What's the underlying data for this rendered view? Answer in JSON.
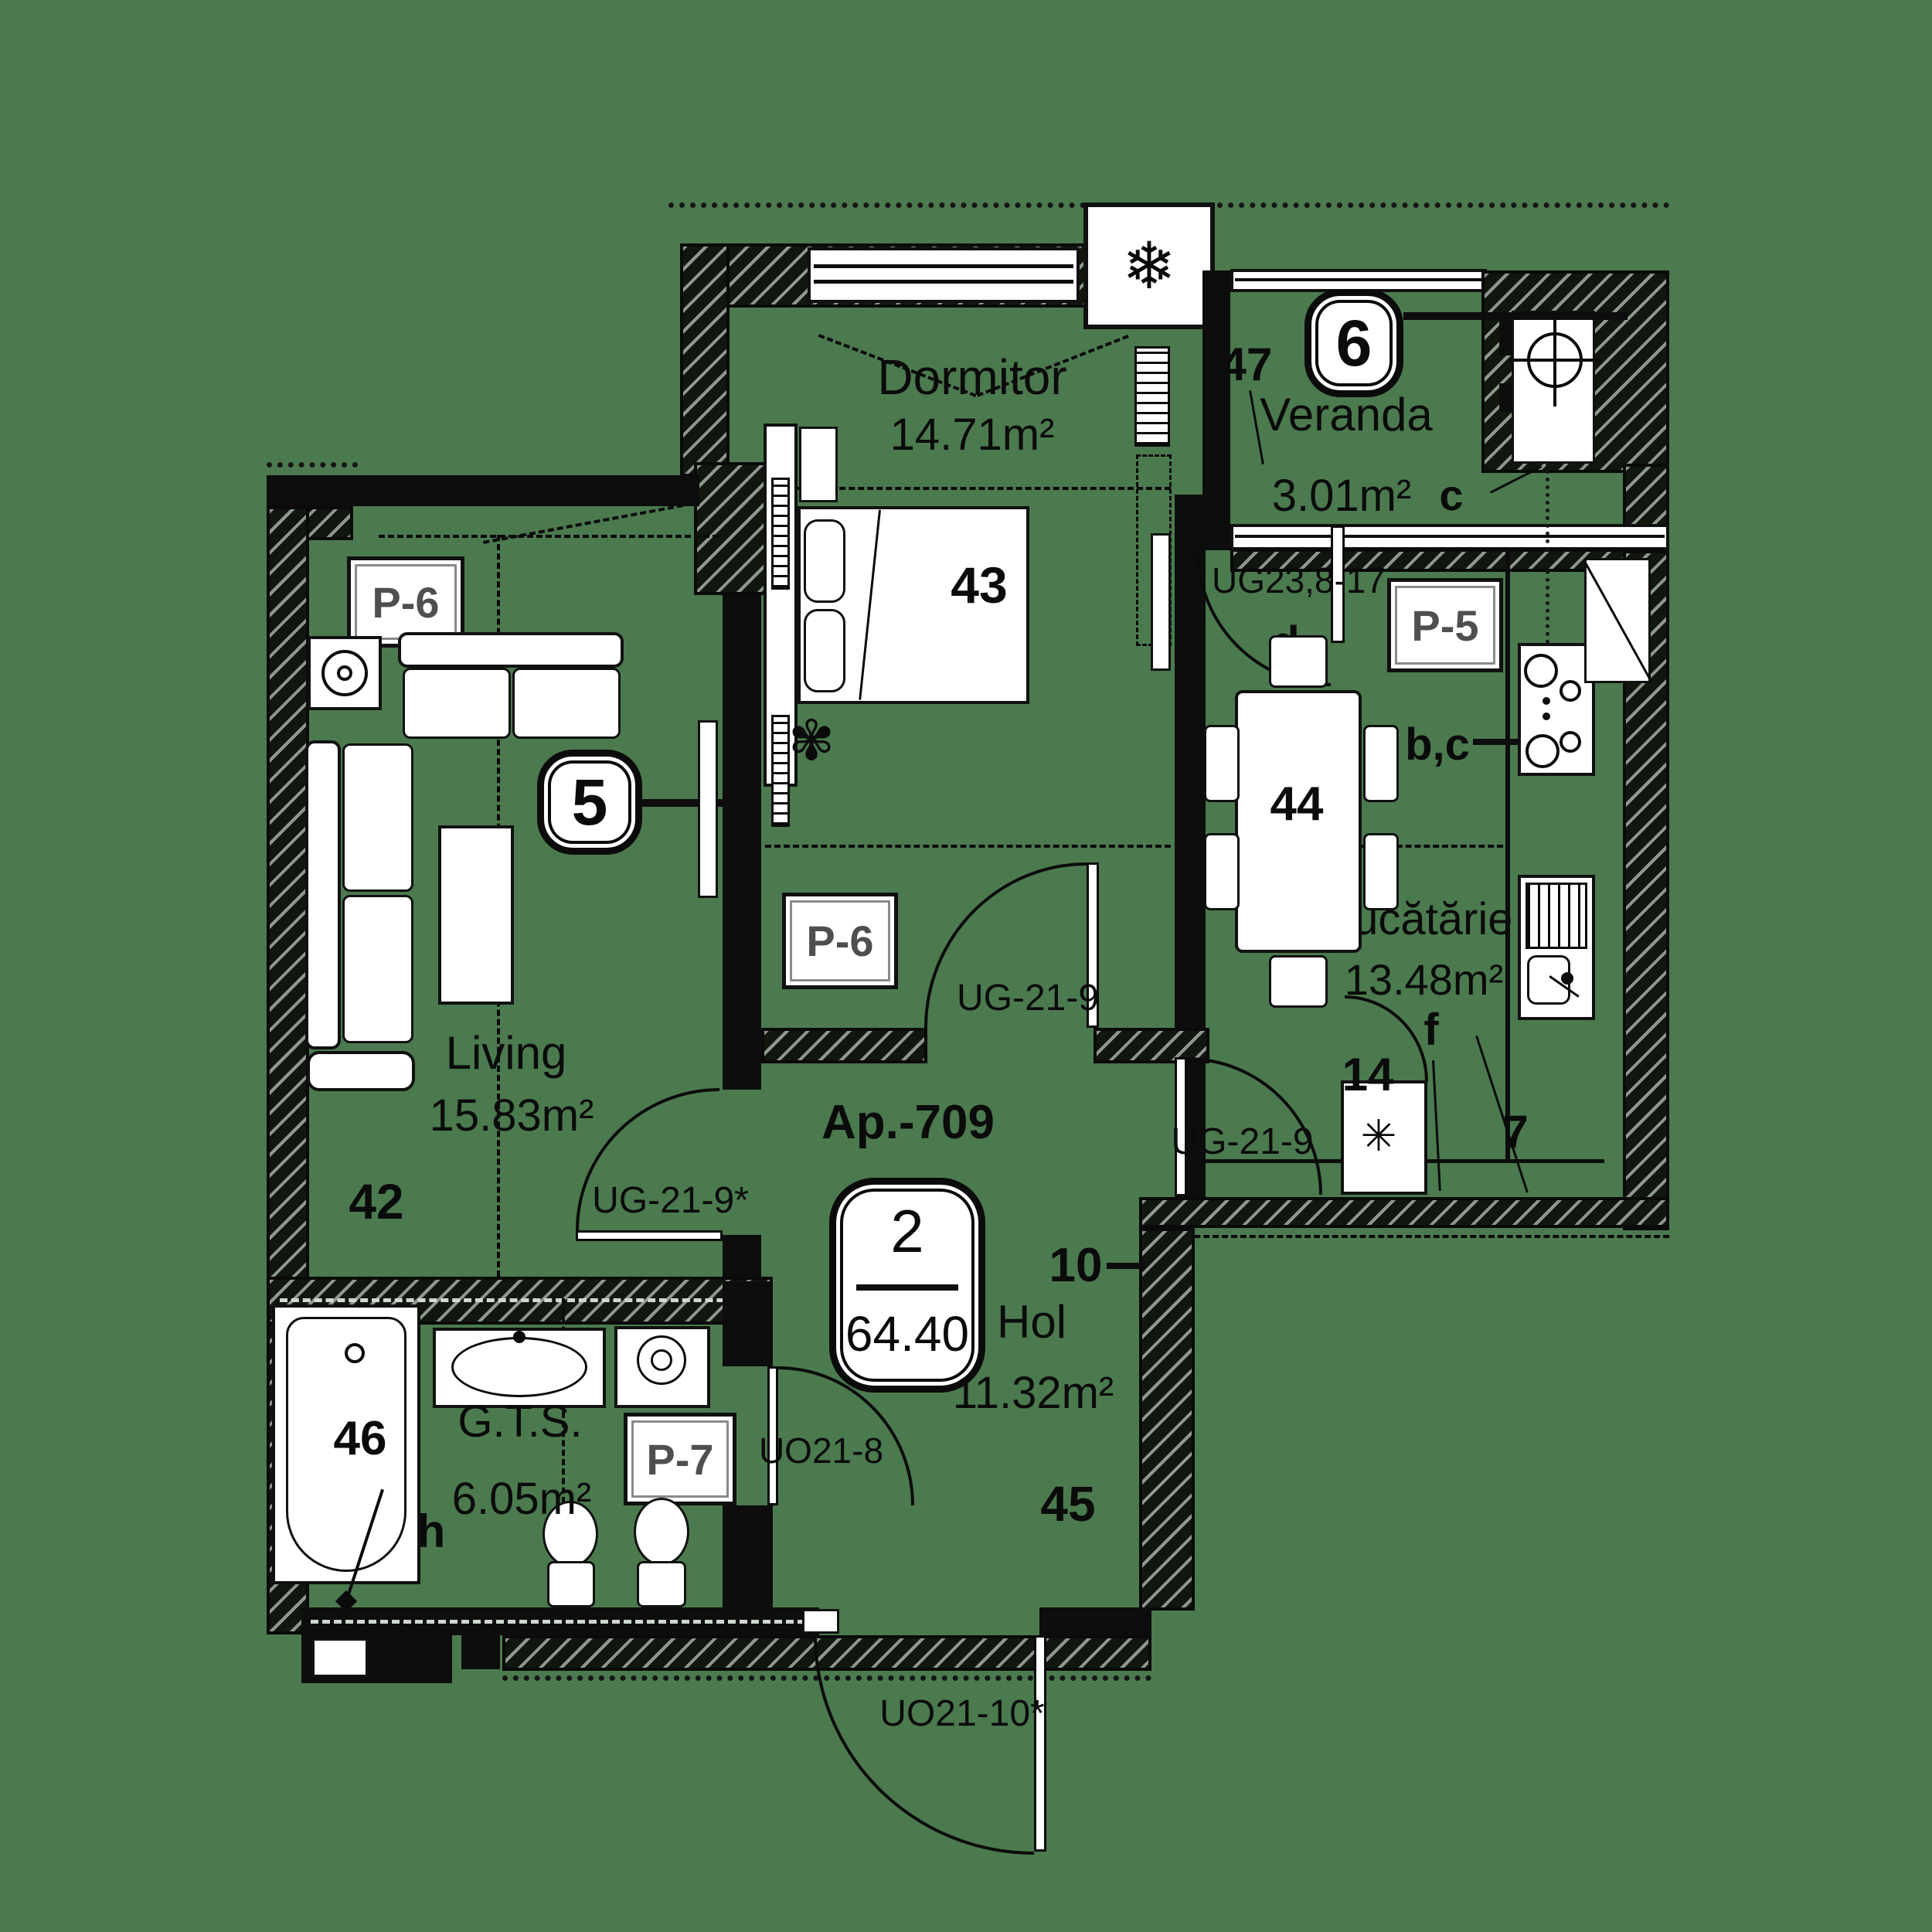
{
  "apartment": {
    "label": "Ap.-709",
    "rooms_count": "2",
    "total_area": "64.40"
  },
  "sections": {
    "s5": "5",
    "s6": "6"
  },
  "rooms": {
    "dormitor": {
      "name": "Dormitor",
      "area": "14.71m²",
      "furniture_no": "43"
    },
    "veranda": {
      "name": "Veranda",
      "area": "3.01m²",
      "position_no": "47",
      "letter_c": "c"
    },
    "bucatarie": {
      "name": "Bucătărie",
      "area": "13.48m²",
      "table_no": "44",
      "fridge_no": "14",
      "letter_bc": "b,c",
      "letter_d": "d",
      "letter_f": "f",
      "letter_7": "7"
    },
    "living": {
      "name": "Living",
      "area": "15.83m²",
      "position_no": "42"
    },
    "hol": {
      "name": "Hol",
      "area": "11.32m²",
      "position_no": "45",
      "position_no_10": "10"
    },
    "gts": {
      "name": "G.T.S.",
      "area": "6.05m²",
      "tub_no": "46",
      "letter_h": "h"
    }
  },
  "panels": {
    "p6_living": "P-6",
    "p6_dormitor": "P-6",
    "p5": "P-5",
    "p7": "P-7"
  },
  "doors": {
    "dormitor_hol": "UG-21-9",
    "kitchen_hol": "UG-21-9",
    "living_hol": "UG-21-9*",
    "veranda_kitchen": "UG23,8-17",
    "gts_hol": "UO21-8",
    "entrance": "UO21-10*"
  },
  "icons": {
    "ac_snowflake": "❄",
    "fridge_asterisk": "✳",
    "plant_flower": "✾"
  },
  "colors": {
    "background": "#4b7a4e",
    "wall": "#0d0d0d",
    "hatch_light": "#8e988e",
    "furniture": "#ffffff",
    "panel_text": "#4f4f4f"
  }
}
